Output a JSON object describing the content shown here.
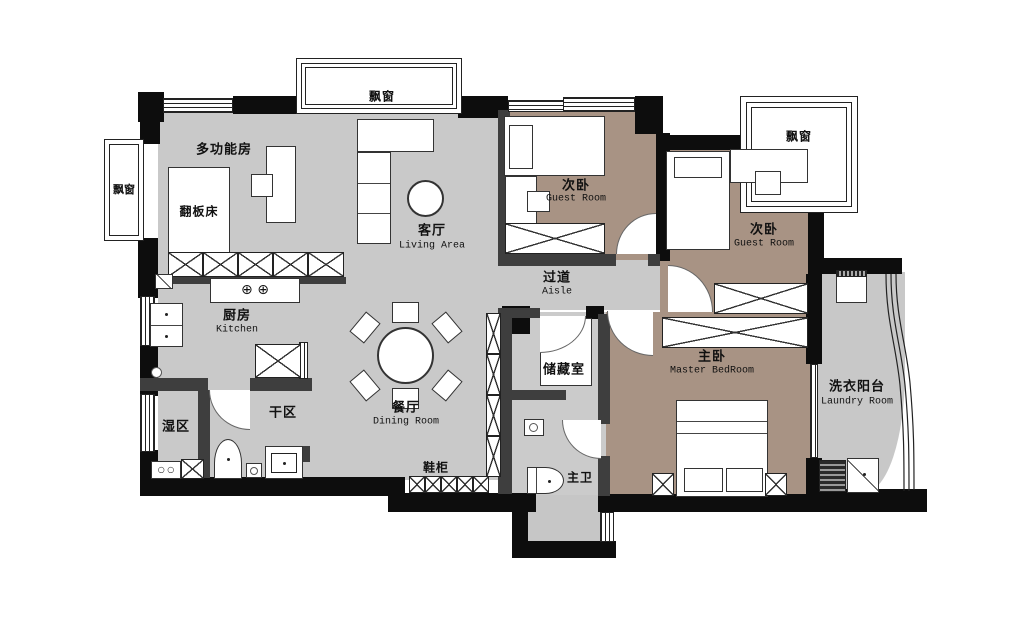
{
  "plan_title": "apartment floor plan",
  "colors": {
    "floor_main": "#c9c9c9",
    "floor_bedroom": "#a89384",
    "floor_bath": "#cbcbcb",
    "floor_laundry": "#c8c8c8",
    "wall": "#0d0d0d"
  },
  "labels": {
    "bay_top": "飘窗",
    "bay_left": "飘窗",
    "bay_right": "飘窗",
    "multi_room": "多功能房",
    "flip_bed": "翻板床",
    "living_zh": "客厅",
    "living_en": "Living Area",
    "guest1_zh": "次卧",
    "guest1_en": "Guest Room",
    "guest2_zh": "次卧",
    "guest2_en": "Guest Room",
    "aisle_zh": "过道",
    "aisle_en": "Aisle",
    "kitchen_zh": "厨房",
    "kitchen_en": "Kitchen",
    "storage": "储藏室",
    "master_zh": "主卧",
    "master_en": "Master BedRoom",
    "dining_zh": "餐厅",
    "dining_en": "Dining Room",
    "dry_area": "干区",
    "wet_area": "湿区",
    "shoe_cabinet": "鞋柜",
    "master_bath": "主卫",
    "laundry_zh": "洗衣阳台",
    "laundry_en": "Laundry Room"
  },
  "symbols": {
    "stove_burners": "⊕ ⊕",
    "wet_cabinet": "○ ○"
  }
}
